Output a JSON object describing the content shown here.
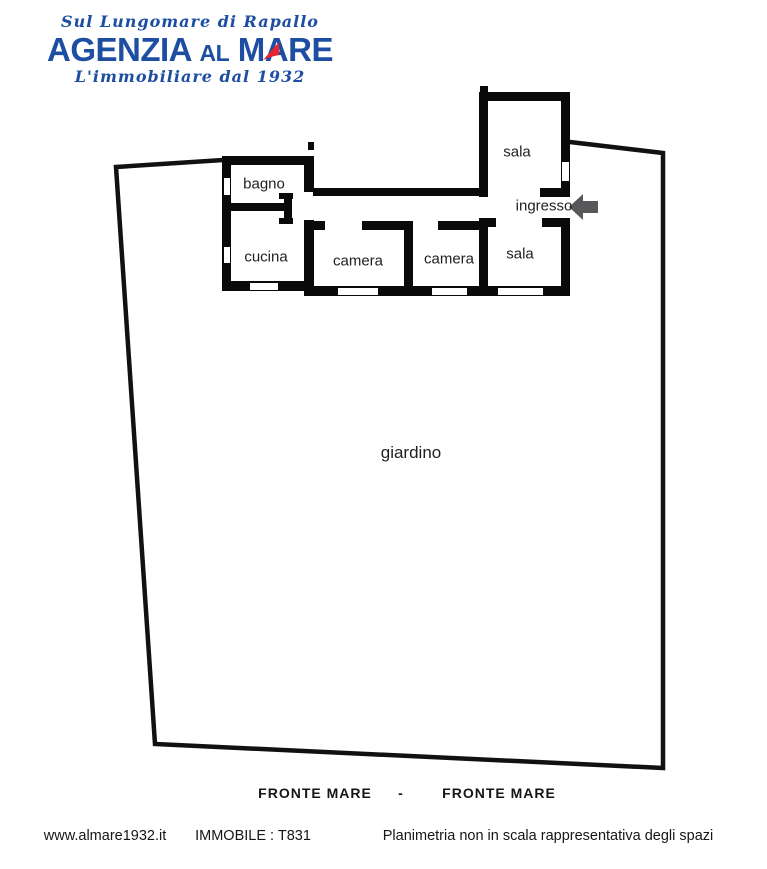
{
  "logo": {
    "tagline_top": "Sul Lungomare di Rapallo",
    "brand_word1": "AGENZIA",
    "brand_word2": "AL",
    "brand_word3_m": "M",
    "brand_word3_a": "A",
    "brand_word3_re": "RE",
    "tagline_bottom": "L'immobiliare dal 1932",
    "colors": {
      "brand_blue": "#1d4ea2",
      "sail_red": "#e5252f"
    }
  },
  "floorplan": {
    "labels": {
      "bagno": "bagno",
      "cucina": "cucina",
      "camera_left": "camera",
      "camera_right": "camera",
      "sala_top": "sala",
      "ingresso": "ingresso",
      "sala_bottom": "sala",
      "giardino": "giardino"
    },
    "colors": {
      "walls": "#0a0a0a",
      "garden_boundary": "#111111",
      "entrance_arrow": "#58585b",
      "openings": "#ffffff"
    }
  },
  "footer": {
    "fronte_mare_left": "FRONTE MARE",
    "separator": "-",
    "fronte_mare_right": "FRONTE MARE",
    "website": "www.almare1932.it",
    "property_ref": "IMMOBILE : T831",
    "disclaimer": "Planimetria non in scala rappresentativa degli spazi"
  }
}
